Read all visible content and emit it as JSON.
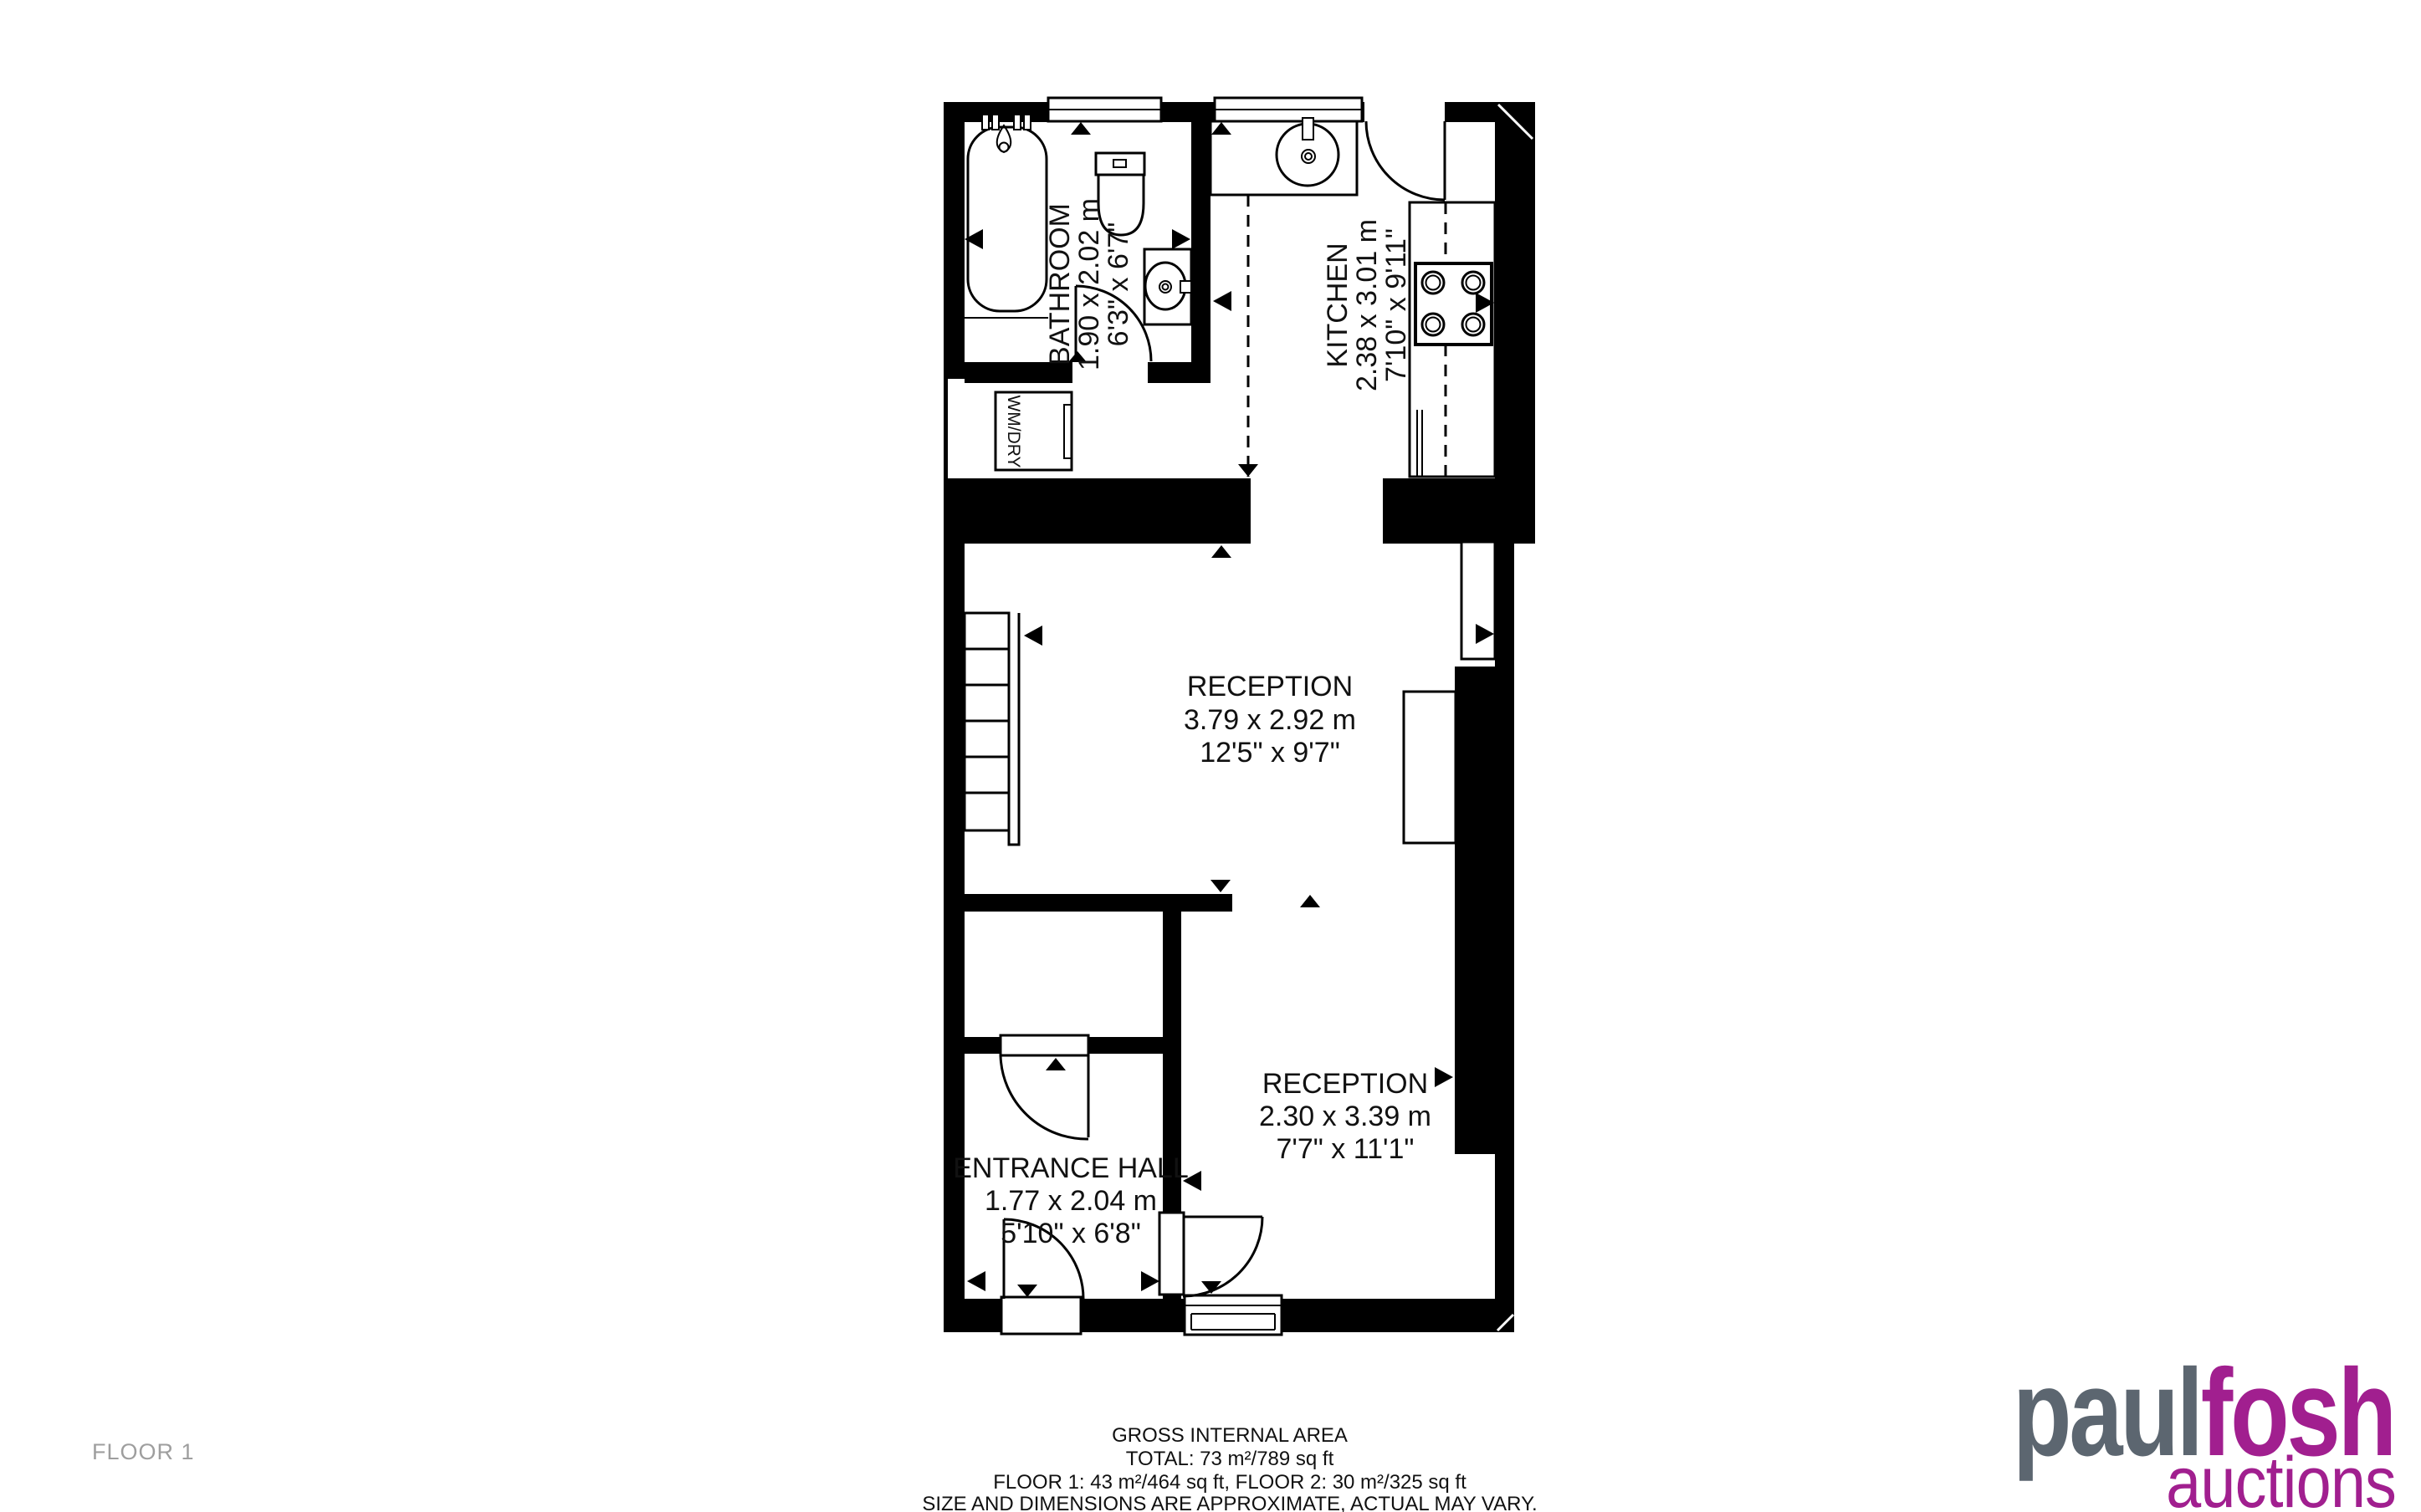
{
  "plan": {
    "rooms": {
      "bathroom": {
        "name": "BATHROOM",
        "metric": "1.90 x 2.02 m",
        "imperial": "6'3\" x 6'7\""
      },
      "kitchen": {
        "name": "KITCHEN",
        "metric": "2.38 x 3.01 m",
        "imperial": "7'10\" x 9'11\""
      },
      "reception1": {
        "name": "RECEPTION",
        "metric": "3.79 x 2.92 m",
        "imperial": "12'5\" x 9'7\""
      },
      "reception2": {
        "name": "RECEPTION",
        "metric": "2.30 x 3.39 m",
        "imperial": "7'7\" x 11'1\""
      },
      "entrance_hall": {
        "name": "ENTRANCE HALL",
        "metric": "1.77 x 2.04 m",
        "imperial": "5'10\" x 6'8\""
      }
    },
    "appliance_label": "WM/DRY"
  },
  "footer": {
    "title": "GROSS INTERNAL AREA",
    "total": "TOTAL: 73 m²/789 sq ft",
    "floors": "FLOOR 1: 43 m²/464 sq ft, FLOOR 2: 30 m²/325 sq ft",
    "disclaimer": "SIZE AND DIMENSIONS ARE APPROXIMATE, ACTUAL MAY VARY."
  },
  "floor_label": "FLOOR 1",
  "logo": {
    "word1": "paul",
    "word2": "fosh",
    "word3": "auctions"
  },
  "colors": {
    "wall": "#000000",
    "logo_gray": "#5c6670",
    "logo_purple": "#a11f8f",
    "floor_label_gray": "#9e9e9e"
  }
}
